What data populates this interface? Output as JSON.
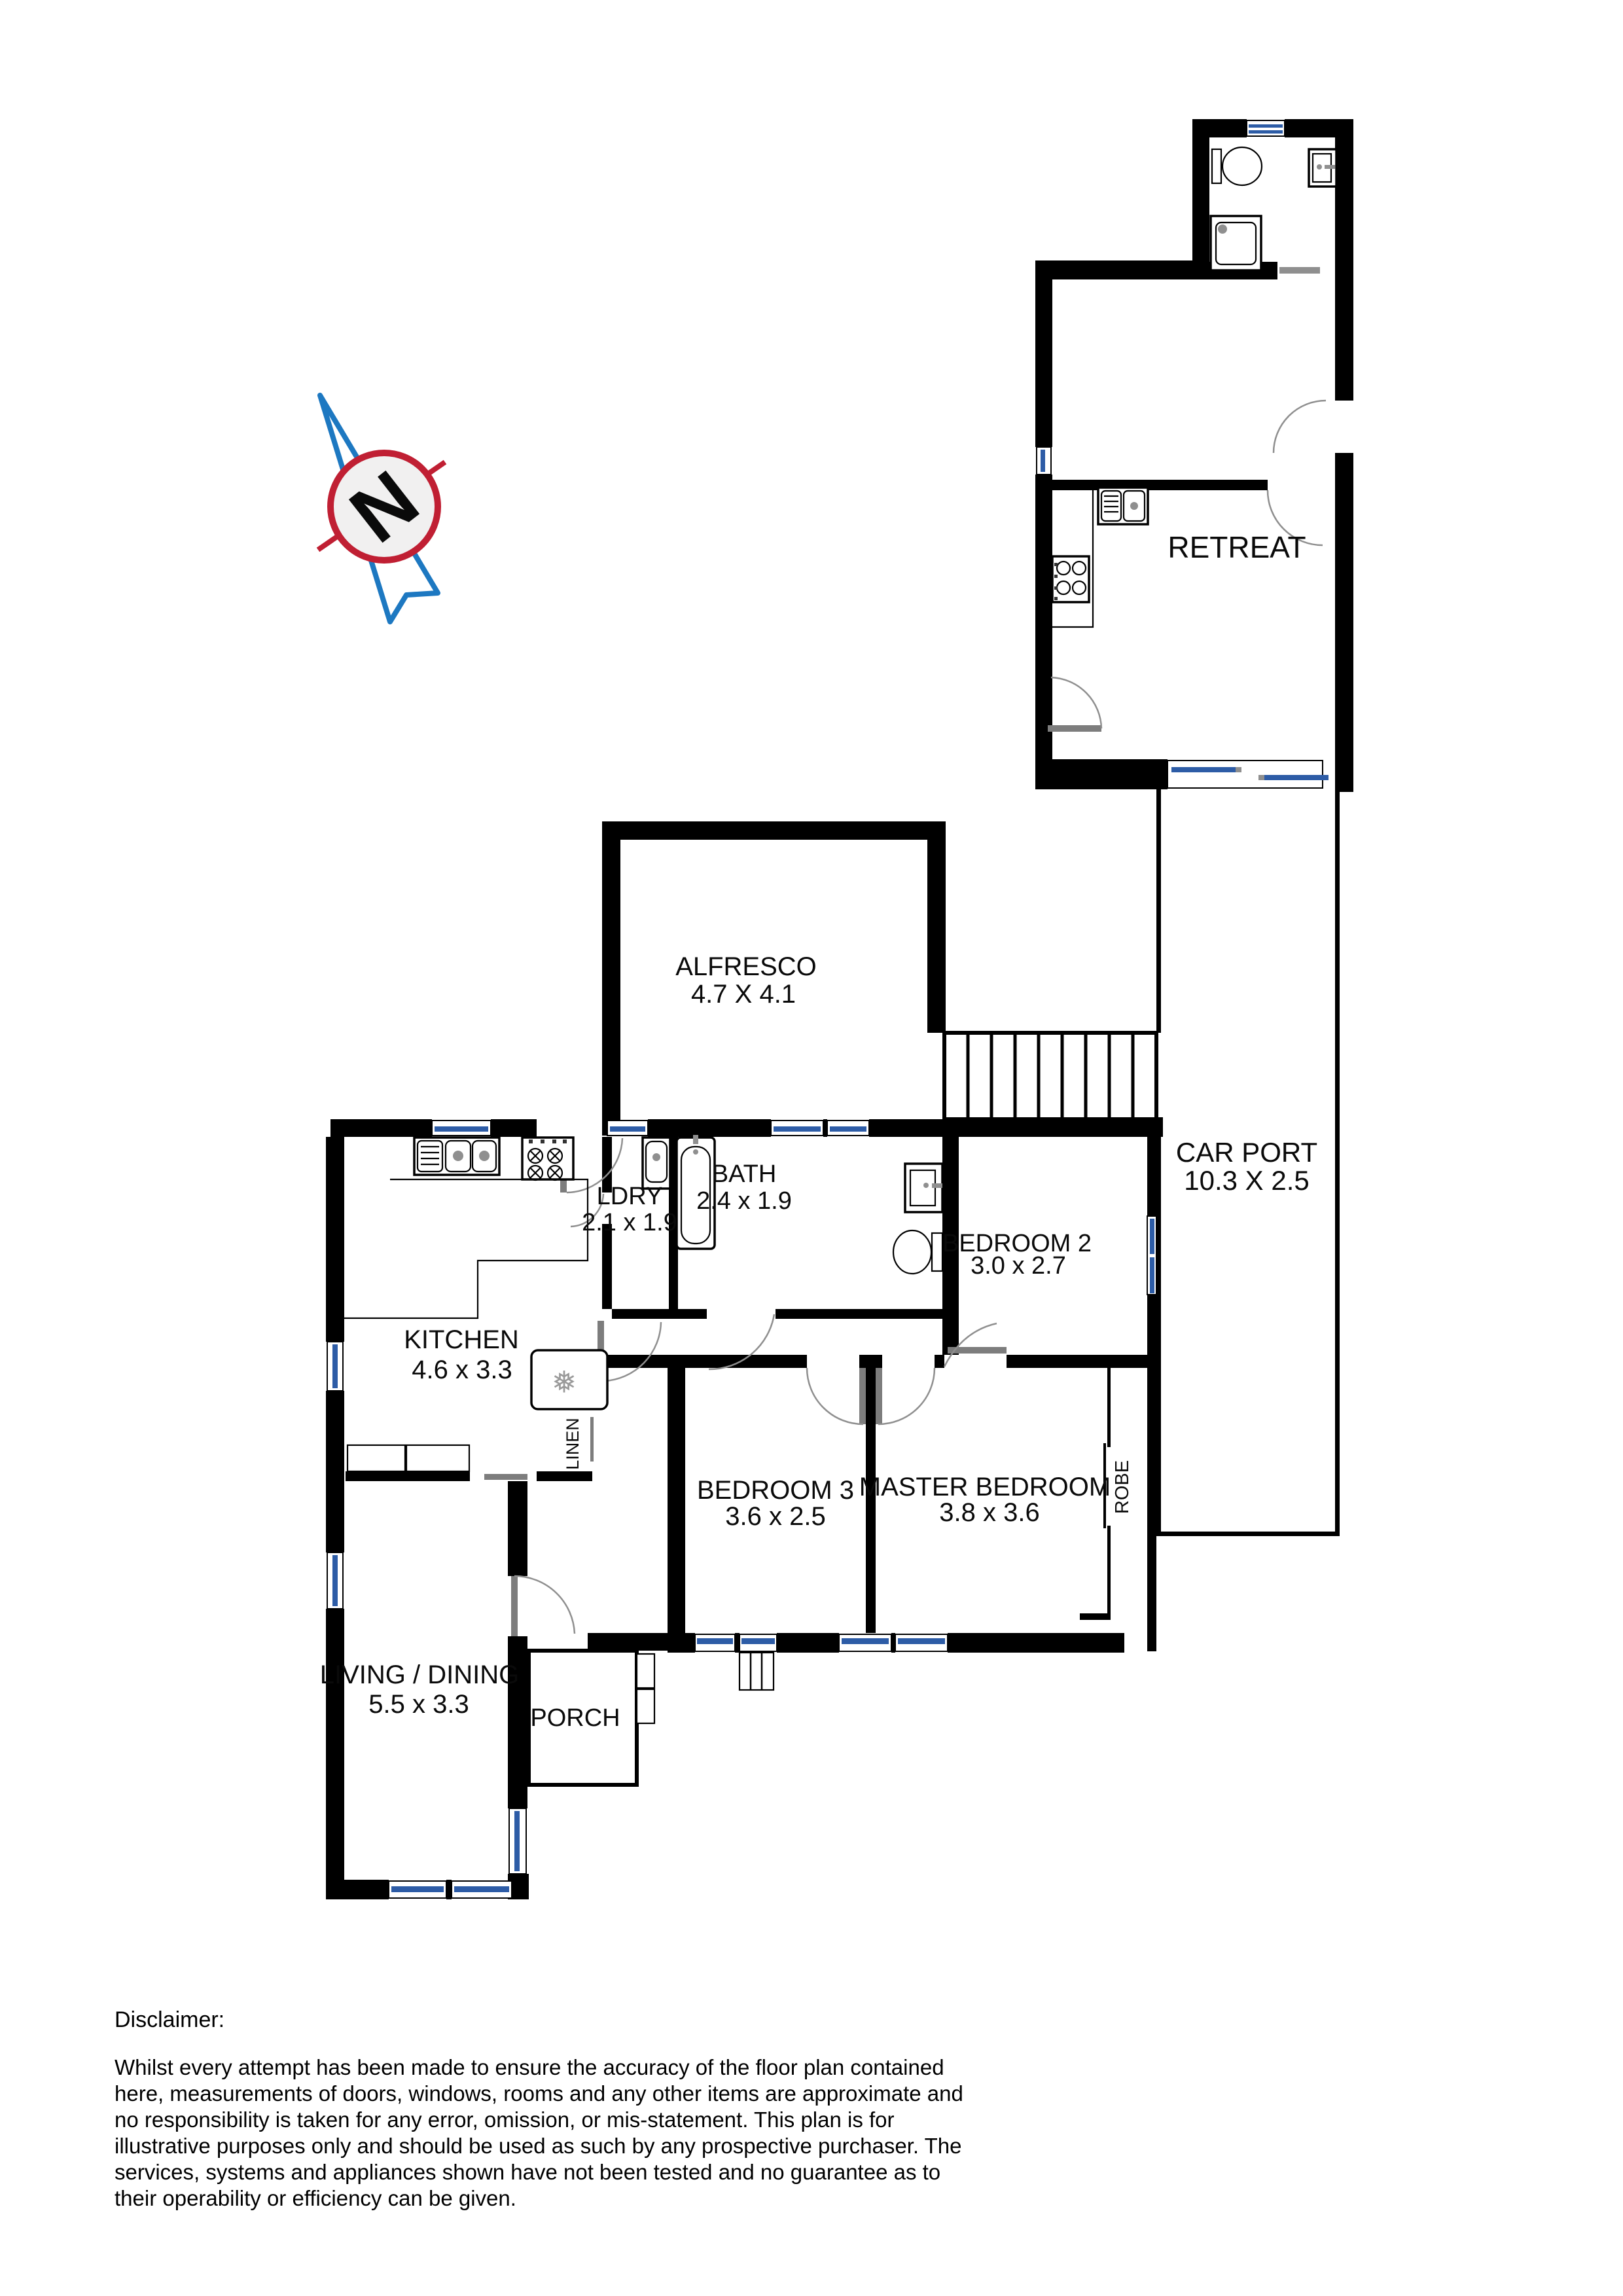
{
  "document": {
    "type": "floor-plan"
  },
  "compass": {
    "letter": "N"
  },
  "rooms": {
    "retreat": {
      "label": "RETREAT"
    },
    "alfresco": {
      "label": "ALFRESCO",
      "dims": "4.7 X 4.1"
    },
    "carport": {
      "label": "CAR PORT",
      "dims": "10.3 X 2.5"
    },
    "laundry": {
      "label": "LDRY",
      "dims": "2.1 x 1.9"
    },
    "bath": {
      "label": "BATH",
      "dims": "2.4 x 1.9"
    },
    "bedroom2": {
      "label": "BEDROOM 2",
      "dims": "3.0 x 2.7"
    },
    "kitchen": {
      "label": "KITCHEN",
      "dims": "4.6 x 3.3"
    },
    "bedroom3": {
      "label": "BEDROOM 3",
      "dims": "3.6 x 2.5"
    },
    "master_bedroom": {
      "label": "MASTER BEDROOM",
      "dims": "3.8 x 3.6"
    },
    "living_dining": {
      "label": "LIVING / DINING",
      "dims": "5.5 x 3.3"
    },
    "porch": {
      "label": "PORCH"
    },
    "linen": {
      "label": "LINEN"
    },
    "robe": {
      "label": "ROBE"
    }
  },
  "icons": {
    "fridge_snowflake": "❅"
  },
  "disclaimer": {
    "title": "Disclaimer:",
    "lines": [
      "Whilst every attempt has been made to ensure the accuracy of the floor plan contained",
      "here, measurements of doors, windows, rooms and any other items are approximate and",
      "no responsibility is taken for any error, omission, or mis-statement. This plan is for",
      "illustrative purposes only and should be used as such by any prospective purchaser. The",
      "services, systems and appliances shown have not been tested and no guarantee as to",
      "their operability or efficiency can be given."
    ]
  },
  "colors": {
    "wall": "#000000",
    "window_glass": "#2d5ca6",
    "door_leaf": "#7d7d7d",
    "compass_red": "#c01f33",
    "compass_blue": "#1d78c1"
  }
}
